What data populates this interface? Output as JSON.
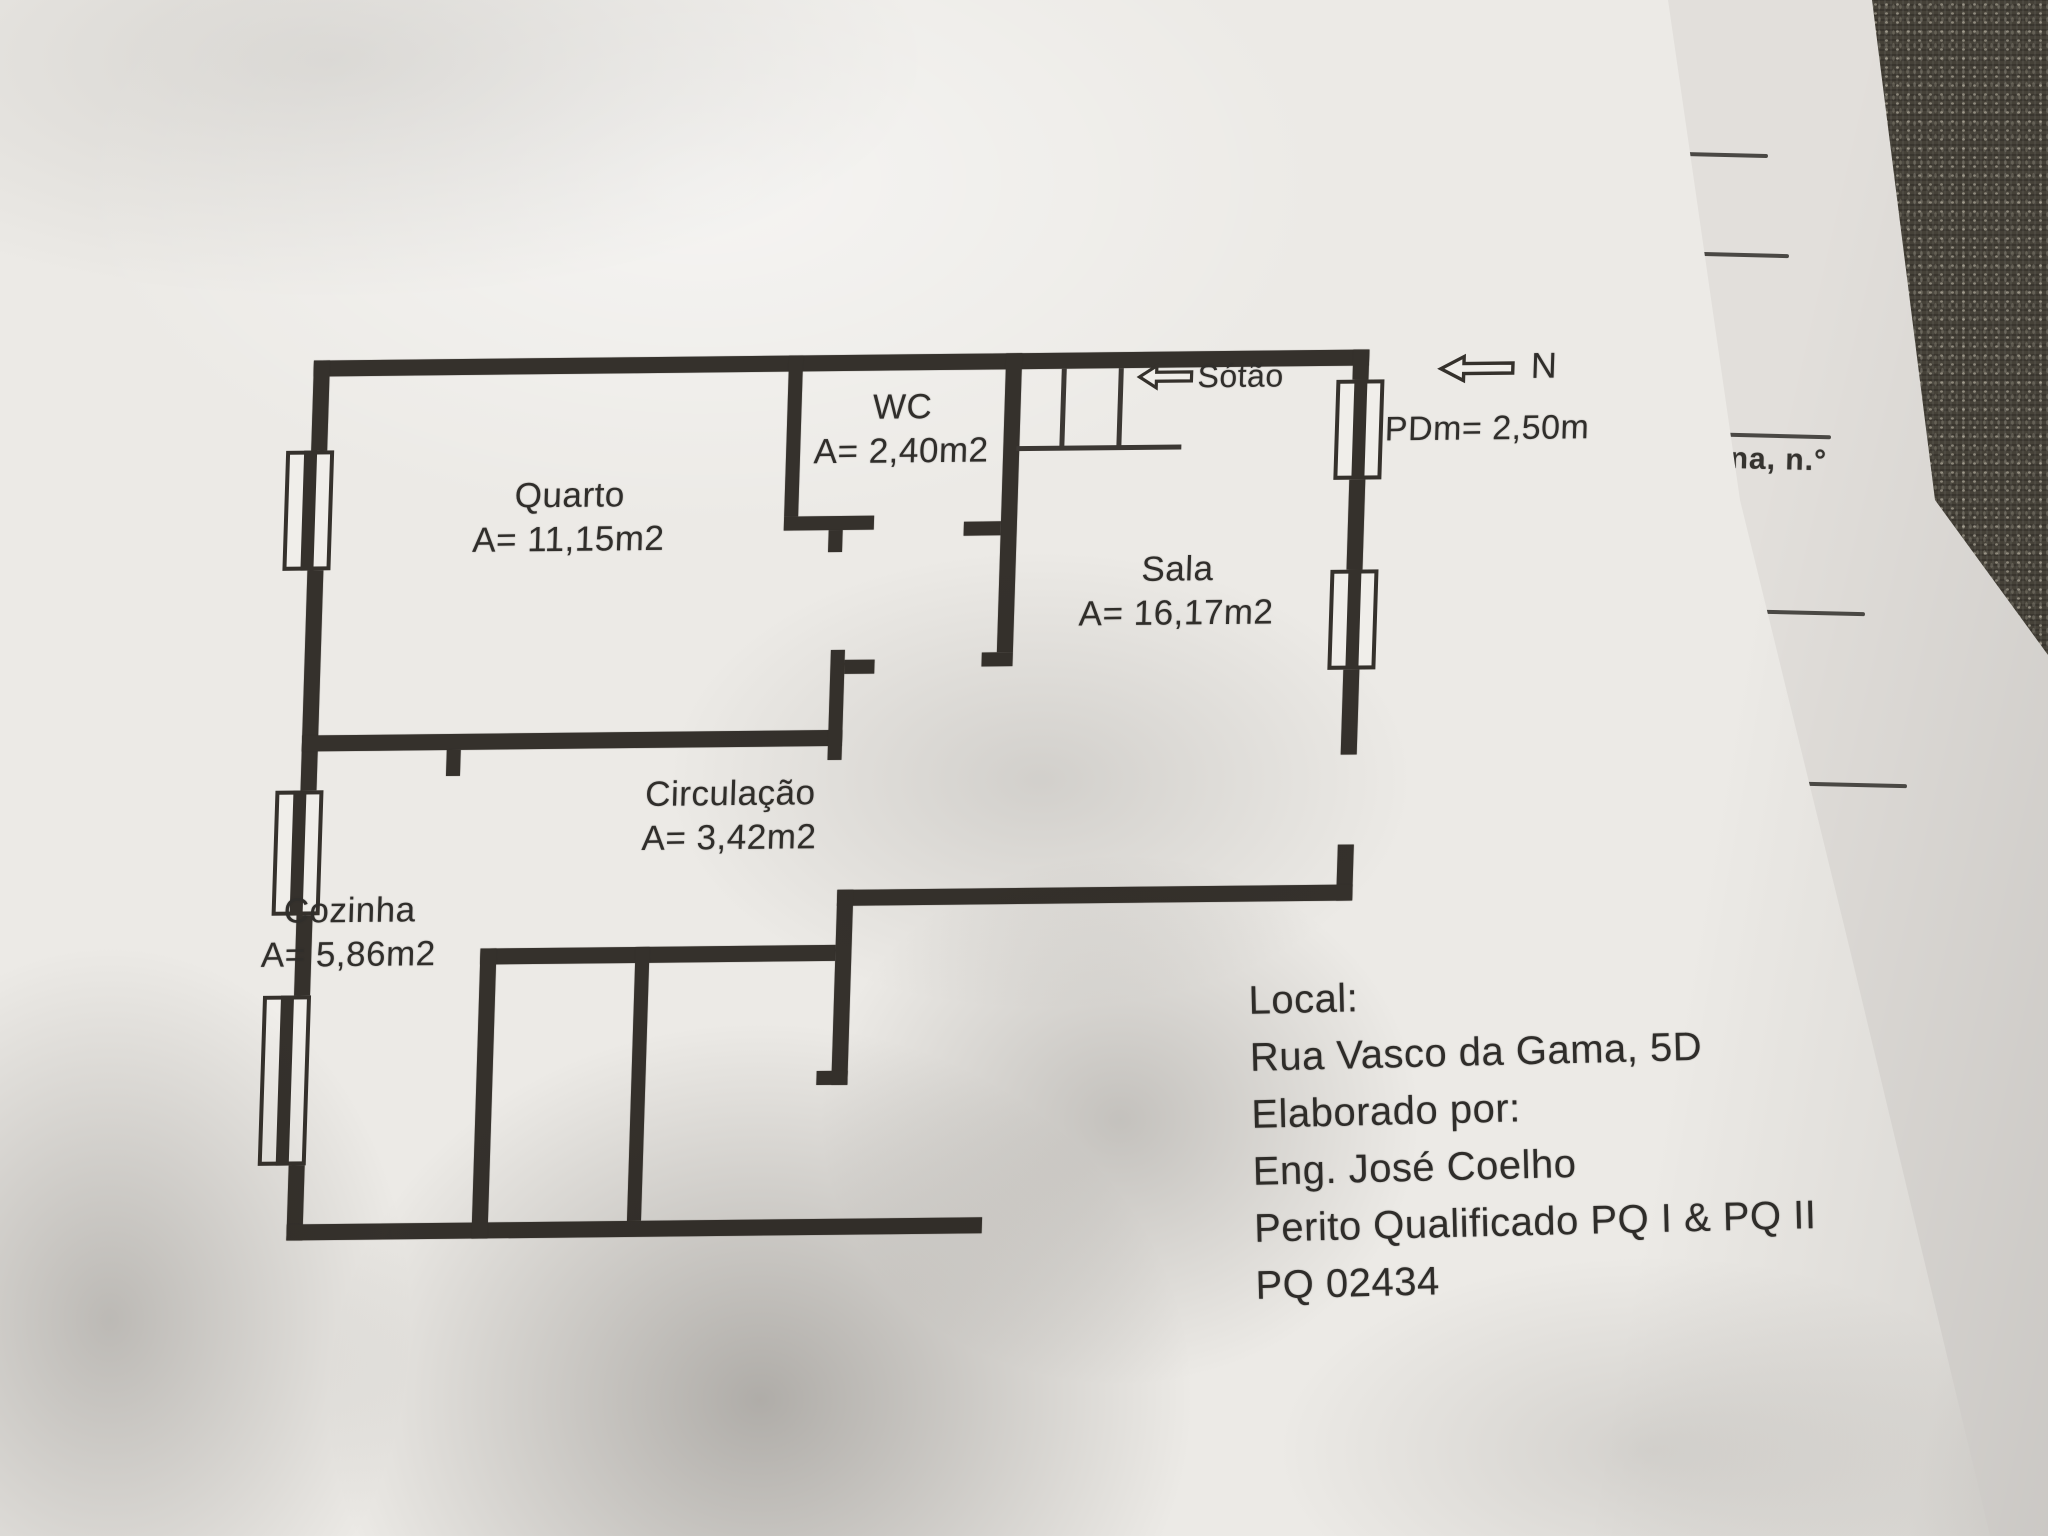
{
  "plan": {
    "rooms": [
      {
        "name": "Quarto",
        "area": "A= 11,15m2"
      },
      {
        "name": "WC",
        "area": "A= 2,40m2"
      },
      {
        "name": "Sala",
        "area": "A= 16,17m2"
      },
      {
        "name": "Circulação",
        "area": "A= 3,42m2"
      },
      {
        "name": "Cozinha",
        "area": "A= 5,86m2"
      }
    ],
    "attic_label": "Sótão",
    "north_label": "N",
    "ceiling_height": "PDm= 2,50m"
  },
  "info_block": {
    "lines": [
      "Local:",
      "Rua Vasco da Gama, 5D",
      "Elaborado por:",
      "Eng. José Coelho",
      "Perito Qualificado PQ I & PQ II",
      "PQ 02434"
    ]
  },
  "underlying_page": {
    "fragment": "ana, n.°"
  },
  "colors": {
    "ink": "#302e2b",
    "walls": "#35312c",
    "paper": "#eceae6",
    "under_paper": "#e2dfdb",
    "fabric": "#454138"
  }
}
